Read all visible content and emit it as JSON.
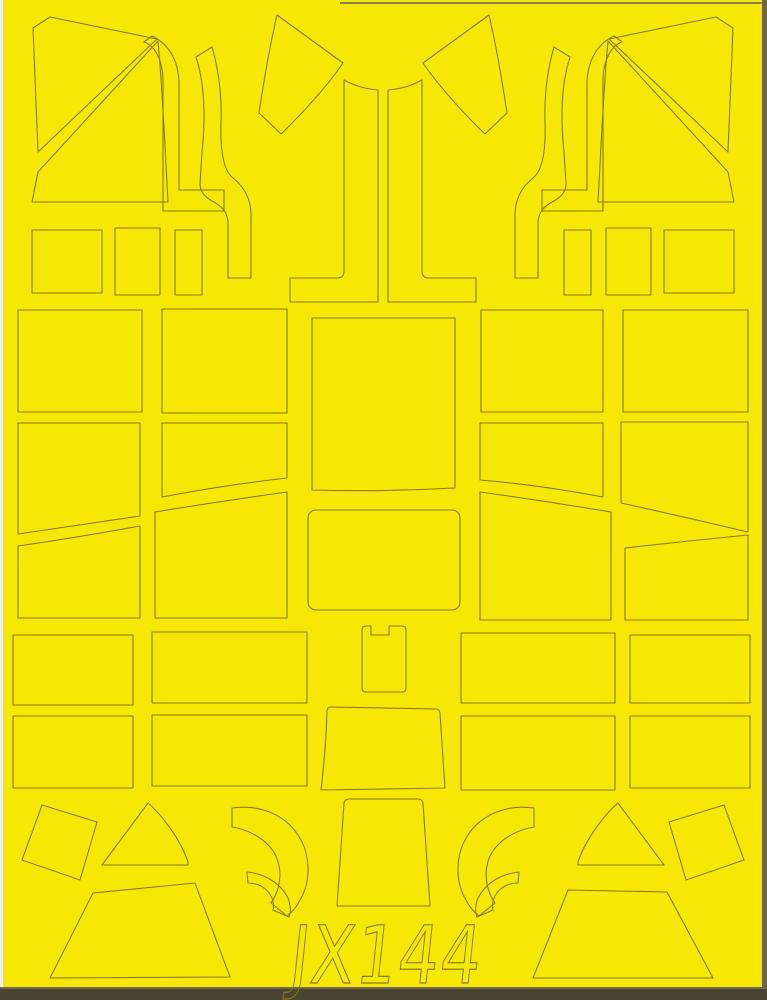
{
  "sheet": {
    "product_code": "JX144",
    "colors": {
      "paper_yellow": "#f6e704",
      "cut_line": "#8a7b0a",
      "sheet_edge_dark": "#4a4533",
      "sheet_edge_mid": "#6e6647",
      "margin_white": "#f0efe9"
    },
    "label": {
      "text": "JX144",
      "x": 288,
      "y": 983,
      "font_size": 80,
      "text_length": 192,
      "skew": -6
    },
    "furniture": [
      {
        "name": "sheet-background",
        "x": 0,
        "y": 0,
        "w": 767,
        "h": 1000,
        "fill": "#f6e704"
      },
      {
        "name": "margin-left-white",
        "x": 0,
        "y": 0,
        "w": 3,
        "h": 1000,
        "fill": "#f0efe9"
      },
      {
        "name": "sheet-edge-right",
        "x": 762,
        "y": 0,
        "w": 5,
        "h": 1000,
        "fill": "#6e6647"
      },
      {
        "name": "sheet-edge-top",
        "x": 340,
        "y": 2,
        "w": 422,
        "h": 2,
        "fill": "#8a7f55"
      },
      {
        "name": "sheet-edge-bottom-line",
        "x": 0,
        "y": 987,
        "w": 767,
        "h": 2,
        "fill": "#72694a"
      },
      {
        "name": "sheet-edge-bottom",
        "x": 0,
        "y": 989,
        "w": 767,
        "h": 11,
        "fill": "#4a4533"
      }
    ],
    "pieces": [
      {
        "name": "mask-windscreen-triangle-left",
        "d": "M33,28 L50,17 L157,39 L38,152 Z"
      },
      {
        "name": "mask-canopy-band-left",
        "d": "M158,41 L38,172 L32,202 L168,202 C165,150 163,95 158,41 Z"
      },
      {
        "name": "mask-frame-strip-narrow-left",
        "d": "M152,36 C167,43 178,58 179,82 L179,190 L224,190 L224,211 L163,211 L163,82 C163,60 155,46 144,42 Z"
      },
      {
        "name": "mask-frame-strip-wide-left",
        "d": "M196,57 C204,82 206,115 202,152 L200,184 C200,192 205,197 212,201 C224,207 228,214 228,224 L228,278 L251,278 L251,215 C251,198 243,186 233,178 C224,171 220,152 221,122 C222,94 218,67 212,47 Z"
      },
      {
        "name": "mask-quarter-wing-left",
        "d": "M277,15 L343,63 C328,85 303,113 281,134 L259,113 C264,80 270,45 277,15 Z"
      },
      {
        "name": "mask-center-pillar-left",
        "d": "M344,80 C357,87 367,89 378,90 L378,302 L290,302 L290,278 L337,278 Q344,278 344,271 Z"
      },
      {
        "name": "mask-center-pillar-right",
        "d": "M422,80 C409,87 399,89 388,90 L388,302 L476,302 L476,278 L429,278 Q422,278 422,271 Z"
      },
      {
        "name": "mask-quarter-wing-right",
        "d": "M489,15 L423,63 C438,85 463,113 485,134 L507,113 C502,80 496,45 489,15 Z"
      },
      {
        "name": "mask-frame-strip-wide-right",
        "d": "M570,57 C562,82 560,115 564,152 L566,184 C566,192 561,197 554,201 C542,207 538,214 538,224 L538,278 L515,278 L515,215 C515,198 523,186 533,178 C542,171 546,152 545,122 C544,94 548,67 554,47 Z"
      },
      {
        "name": "mask-frame-strip-narrow-right",
        "d": "M614,36 C599,43 588,58 587,82 L587,190 L542,190 L542,211 L603,211 L603,82 C603,60 611,46 622,42 Z"
      },
      {
        "name": "mask-canopy-band-right",
        "d": "M608,41 L728,172 L734,202 L598,202 C601,150 603,95 608,41 Z"
      },
      {
        "name": "mask-windscreen-triangle-right",
        "d": "M733,28 L716,17 L609,39 L728,152 Z"
      },
      {
        "name": "mask-small-rect-1-left",
        "d": "M32,230 h70 v63 h-70 Z"
      },
      {
        "name": "mask-small-rect-2-left",
        "d": "M115,228 h45 v67 h-45 Z"
      },
      {
        "name": "mask-small-rect-3-left",
        "d": "M175,230 h27 v65 h-27 Z"
      },
      {
        "name": "mask-small-rect-3-right",
        "d": "M564,230 h27 v65 h-27 Z"
      },
      {
        "name": "mask-small-rect-2-right",
        "d": "M606,228 h45 v67 h-45 Z"
      },
      {
        "name": "mask-small-rect-1-right",
        "d": "M664,230 h70 v63 h-70 Z"
      },
      {
        "name": "mask-panel-a1",
        "d": "M18,310 h124 v102 h-124 Z"
      },
      {
        "name": "mask-panel-a2",
        "d": "M162,309 h125 v104 h-125 Z"
      },
      {
        "name": "mask-panel-center-large",
        "d": "M312,318 L455,318 L455,488 Q383,492 312,490 Z"
      },
      {
        "name": "mask-panel-a3",
        "d": "M481,310 h122 v102 h-122 Z"
      },
      {
        "name": "mask-panel-a4",
        "d": "M623,310 h125 v102 h-125 Z"
      },
      {
        "name": "mask-panel-b1",
        "d": "M18,423 L140,423 L140,516 Q80,525 18,534 Z"
      },
      {
        "name": "mask-panel-b2",
        "d": "M162,423 L287,423 L287,478 Q225,485 162,497 Z"
      },
      {
        "name": "mask-panel-b3",
        "d": "M480,423 L603,423 L603,497 Q540,485 480,480 Z"
      },
      {
        "name": "mask-panel-b4",
        "d": "M621,422 L748,422 L748,532 Q685,517 621,503 Z"
      },
      {
        "name": "mask-panel-c1",
        "d": "M18,546 Q80,537 140,526 L140,618 L18,618 Z"
      },
      {
        "name": "mask-panel-c2",
        "d": "M155,512 Q222,501 287,492 L287,618 L155,618 Z"
      },
      {
        "name": "mask-panel-center-rounded",
        "d": "M316,510 h136 a8,8 0 0 1 8,8 v84 a8,8 0 0 1 -8,8 h-136 a8,8 0 0 1 -8,-8 v-84 a8,8 0 0 1 8,-8 Z"
      },
      {
        "name": "mask-panel-c3",
        "d": "M480,492 Q545,501 611,512 L611,620 L480,620 Z"
      },
      {
        "name": "mask-panel-c4",
        "d": "M625,548 Q687,541 748,535 L748,620 L625,620 Z"
      },
      {
        "name": "mask-strip-d1",
        "d": "M13,635 h120 v70 h-120 Z"
      },
      {
        "name": "mask-strip-d2",
        "d": "M152,632 h155 v71 h-155 Z"
      },
      {
        "name": "mask-notched-tab-center",
        "d": "M366,626 L371,626 L371,635 L389,635 L389,626 L402,626 Q406,626 406,630 L406,688 Q406,692 402,692 L366,692 Q362,692 362,688 L362,630 Q362,626 366,626 Z"
      },
      {
        "name": "mask-strip-d3",
        "d": "M461,633 h154 v70 h-154 Z"
      },
      {
        "name": "mask-strip-d4",
        "d": "M630,635 h120 v68 h-120 Z"
      },
      {
        "name": "mask-strip-e1",
        "d": "M13,716 h120 v72 h-120 Z"
      },
      {
        "name": "mask-strip-e2",
        "d": "M152,715 h155 v71 h-155 Z"
      },
      {
        "name": "mask-trapezoid-center-small",
        "d": "M330,707 L436,709 Q439,709 440,713 L445,788 L321,790 Q326,748 327,710 Q328,707 330,707 Z"
      },
      {
        "name": "mask-strip-e3",
        "d": "M461,716 h154 v74 h-154 Z"
      },
      {
        "name": "mask-strip-e4",
        "d": "M630,716 h120 v72 h-120 Z"
      },
      {
        "name": "mask-tilted-square-left",
        "d": "M42,805 L97,822 L80,880 L22,860 Z"
      },
      {
        "name": "mask-gusset-triangle-left",
        "d": "M102,865 L148,803 C160,813 180,838 188,862 L188,865 Z"
      },
      {
        "name": "mask-trapezoid-large-left",
        "d": "M50,978 L93,893 L195,883 L230,977 Z"
      },
      {
        "name": "mask-crescent-large-left",
        "d": "M232,808 C260,804 285,815 298,835 C310,853 312,880 300,900 C296,908 291,913 287,916 L271,903 C280,890 283,872 276,856 C268,840 250,830 232,827 Z"
      },
      {
        "name": "mask-crescent-small-left",
        "d": "M247,872 C266,874 281,884 288,898 C291,906 291,912 289,917 L273,910 C275,900 270,891 261,886 C257,884 252,883 248,883 Z"
      },
      {
        "name": "mask-trapezoid-center-tall",
        "d": "M349,799 Q345,799 344,803 L337,906 L430,906 L423,803 Q422,799 418,799 Z"
      },
      {
        "name": "mask-crescent-large-right",
        "d": "M534,808 C506,804 481,815 468,835 C456,853 454,880 466,900 C470,908 475,913 479,916 L495,903 C486,890 483,872 490,856 C498,840 516,830 534,827 Z"
      },
      {
        "name": "mask-crescent-small-right",
        "d": "M519,872 C500,874 485,884 478,898 C475,906 475,912 477,917 L493,910 C491,900 496,891 505,886 C509,884 514,883 518,883 Z"
      },
      {
        "name": "mask-gusset-triangle-right",
        "d": "M664,865 L618,803 C606,813 586,838 578,862 L578,865 Z"
      },
      {
        "name": "mask-tilted-square-right",
        "d": "M724,805 L669,822 L686,880 L744,860 Z"
      },
      {
        "name": "mask-trapezoid-large-right",
        "d": "M533,978 L568,890 L667,892 L713,978 Z"
      }
    ]
  }
}
